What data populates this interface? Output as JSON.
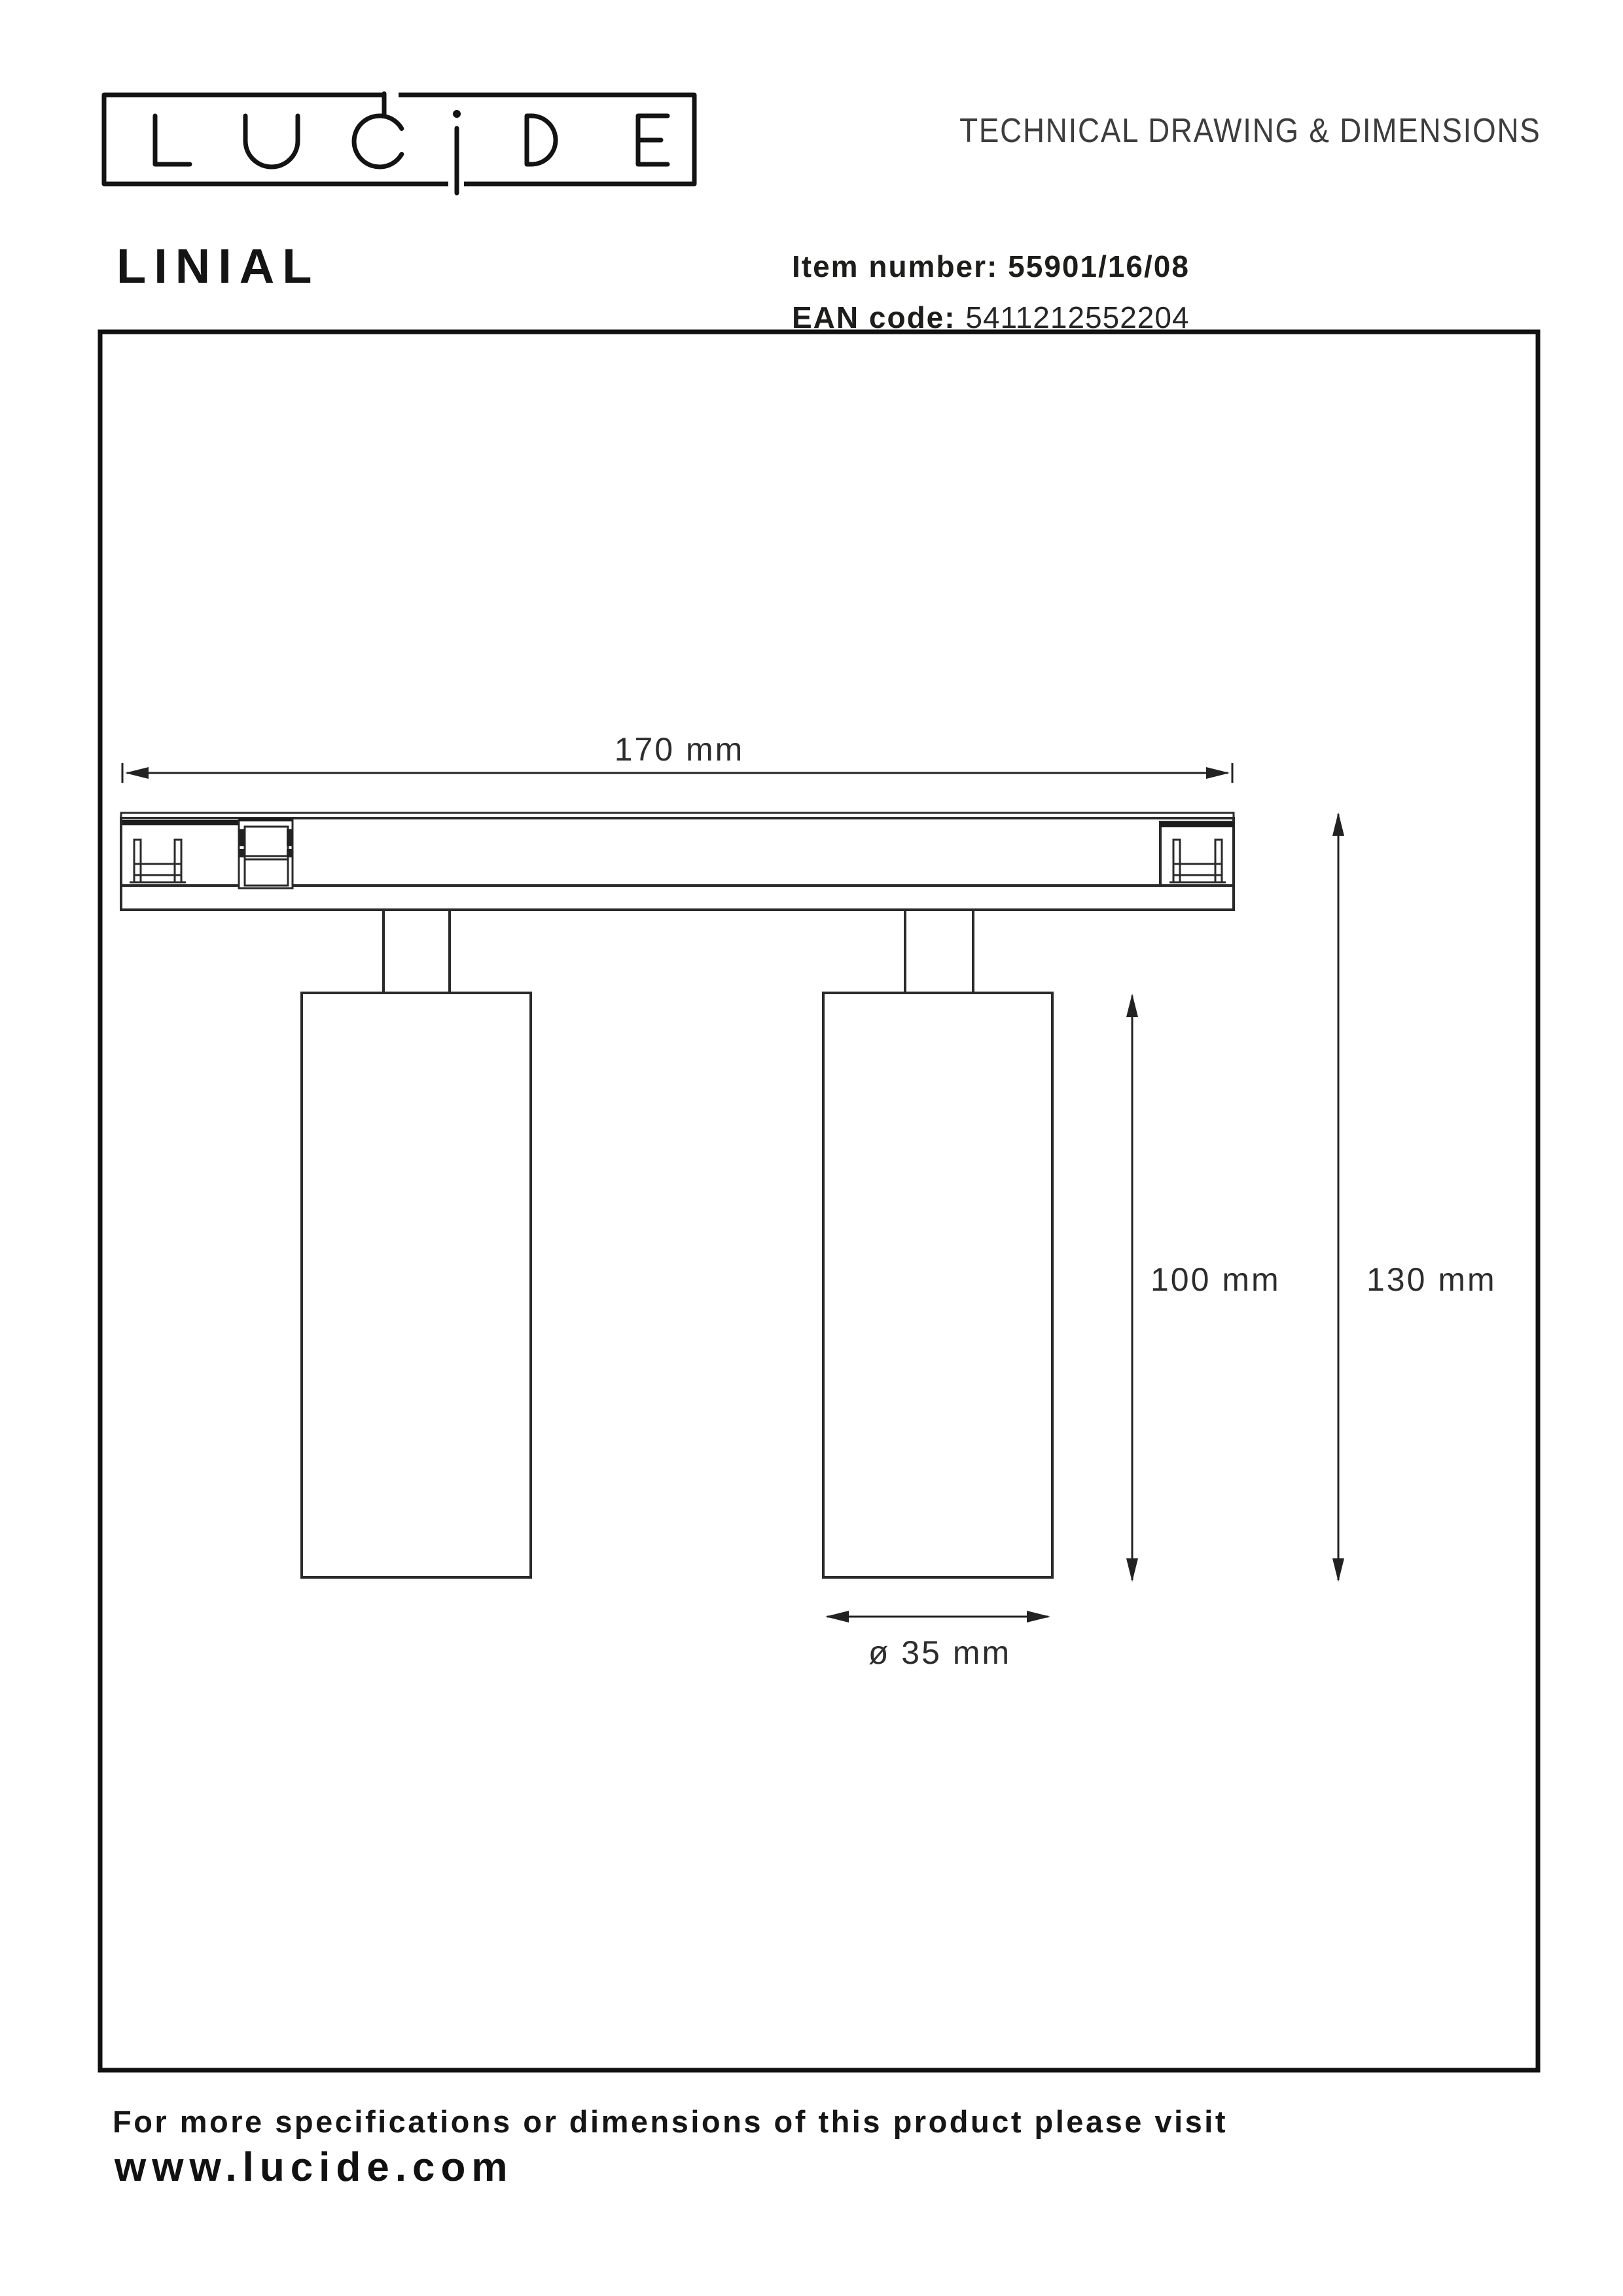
{
  "header": {
    "logo_text": "LUCIDE",
    "doc_title": "TECHNICAL DRAWING & DIMENSIONS"
  },
  "product": {
    "name": "LINIAL",
    "item_label": "Item number:",
    "item_value": "55901/16/08",
    "ean_label": "EAN code:",
    "ean_value": "5411212552204"
  },
  "drawing": {
    "dimensions": {
      "track_width": "170 mm",
      "spot_height": "100 mm",
      "total_height": "130 mm",
      "spot_diameter": "ø 35 mm"
    }
  },
  "footer": {
    "note": "For more specifications or dimensions of this product please visit",
    "website": "www.lucide.com"
  },
  "colors": {
    "ink": "#1d1d1b",
    "line": "#2a2a2a",
    "muted": "#3d3d3d",
    "background": "#ffffff"
  }
}
